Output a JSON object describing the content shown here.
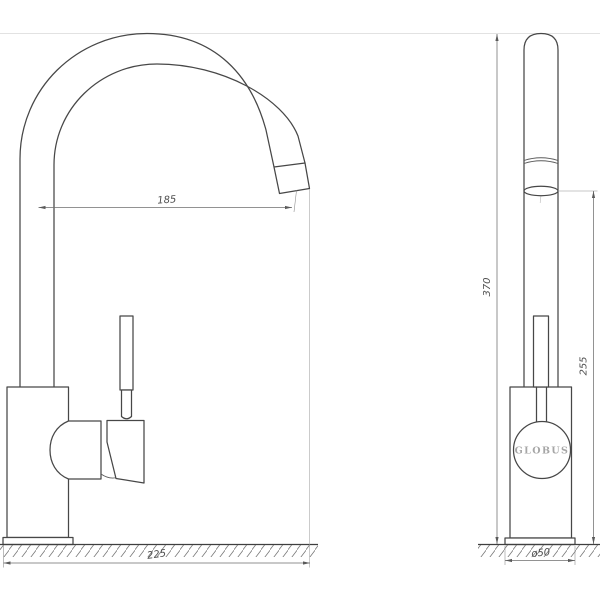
{
  "drawing": {
    "type": "technical-drawing",
    "subject": "single-lever kitchen mixer faucet, two orthographic views",
    "brand": {
      "logo_text": "GLOBUS"
    },
    "dimensions": {
      "spout_reach": "185",
      "overall_depth": "225",
      "overall_height": "370",
      "outlet_height": "255",
      "base_diameter": "ø50"
    },
    "colors": {
      "background": "#ffffff",
      "object_line": "#474747",
      "dimension_line": "#6e6e6e",
      "dimension_text": "#4f4f4f",
      "extension_line_light": "#e2e2e2",
      "ground_line": "#3f3f3f",
      "hatch_stroke": "#7a7a7a",
      "brand_text": "#a6a6a6"
    }
  }
}
